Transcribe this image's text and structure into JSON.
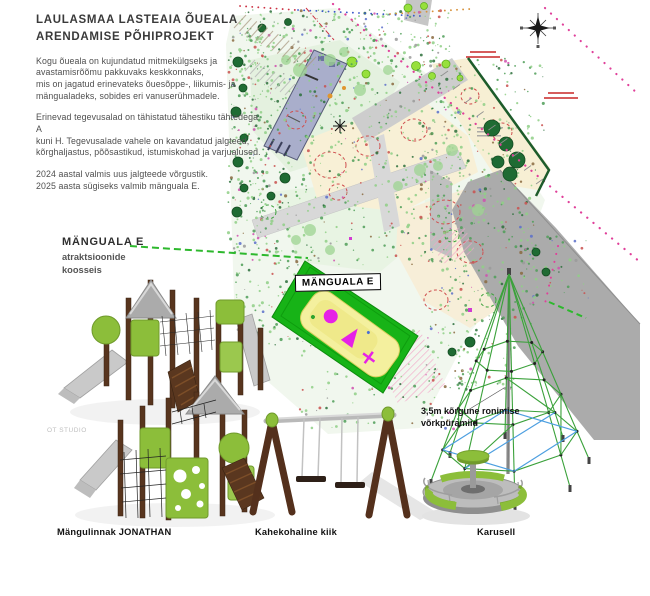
{
  "header": {
    "title": "LAULASMAA LASTEAIA ÕUEALA\nARENDAMISE PÕHIPROJEKT",
    "para1": "Kogu õueala on kujundatud mitmekülgseks ja\navastamisrõõmu pakkuvaks keskkonnaks,\nmis on jagatud erinevateks õuesõppe-, liikumis- ja\nmängualadeks, sobides eri vanuserühmadele.",
    "para2": "Erinevad tegevusalad on tähistatud tähestiku tähtedega A\nkuni H. Tegevusalade vahele on kavandatud jalgteed,\nkõrghaljastus, põõsastikud, istumiskohad ja varjualused.",
    "para3": "2024 aastal valmis uus jalgteede võrgustik.\n2025 aasta sügiseks valmib mänguala E."
  },
  "callout": {
    "title": "MÄNGUALA E",
    "subtitle": "atraktsioonide\nkoosseis"
  },
  "plan": {
    "area_label": "MÄNGUALA E",
    "pyramid_note": "3,5m kõrgune ronimise\nvõrkpüramiid"
  },
  "equipment": {
    "playhouse": "Mängulinnak JONATHAN",
    "swing": "Kahekohaline kiik",
    "carousel": "Karusell"
  },
  "watermark": "OT STUDIO",
  "icons": {
    "compass": "compass-rose-icon"
  },
  "colors": {
    "zone_green": "#17b317",
    "equipment_green": "#8cbe3a",
    "wood_brown": "#58351e",
    "plan_gray": "#adadad",
    "boundary_magenta": "#e0409a",
    "rope_green": "#3aa13a"
  }
}
